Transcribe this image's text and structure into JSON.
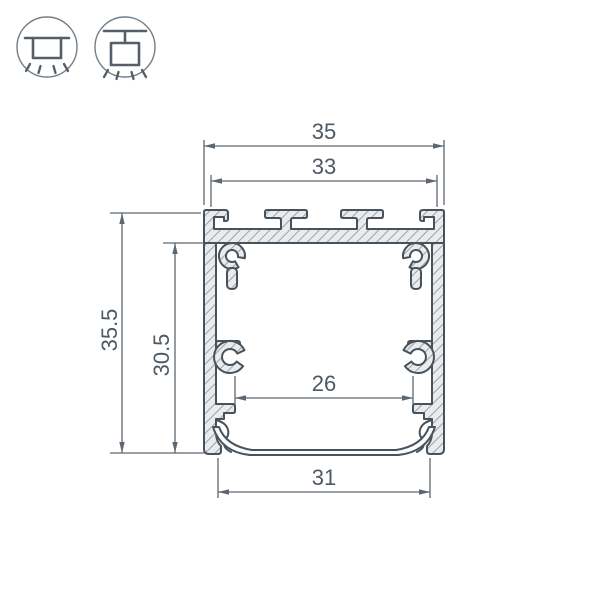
{
  "dimensions": {
    "outer_width": "35",
    "top_inner_width": "33",
    "outer_height": "35.5",
    "inner_height": "30.5",
    "inner_width": "26",
    "bottom_width": "31"
  },
  "icons": [
    {
      "name": "surface-mount-icon"
    },
    {
      "name": "pendant-mount-icon"
    }
  ],
  "colors": {
    "line": "#47525c",
    "dimension": "#5d6771",
    "material_fill": "#e9ebec",
    "hatch": "#9aa3ab",
    "background": "#ffffff"
  }
}
